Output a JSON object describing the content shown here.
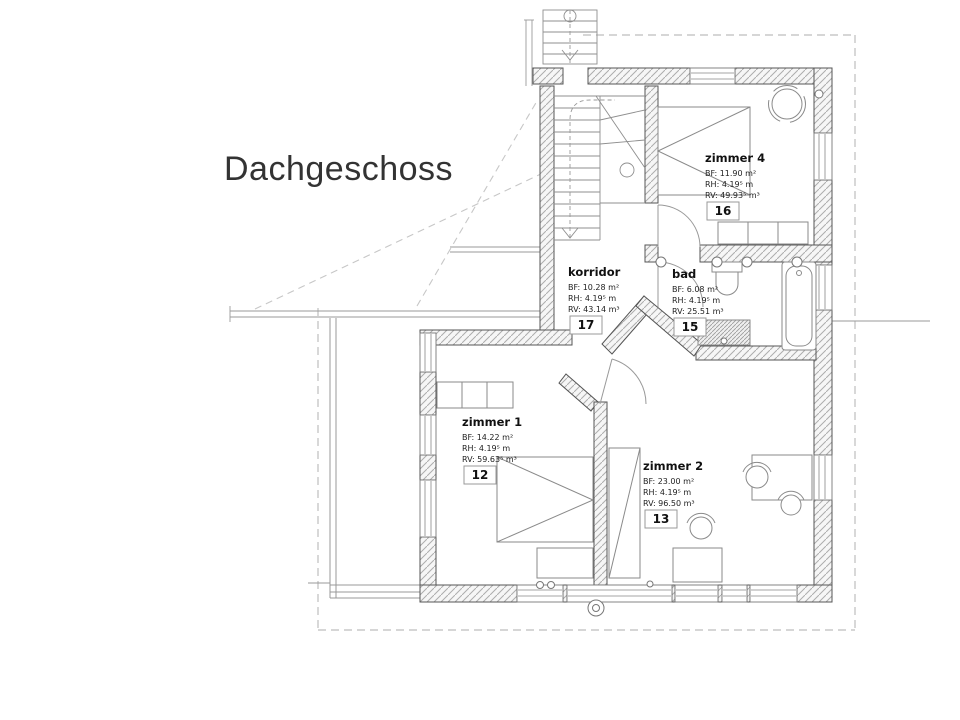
{
  "title": "Dachgeschoss",
  "plan": {
    "rooms": [
      {
        "id": "zimmer4",
        "name": "zimmer 4",
        "bf": "BF: 11.90 m²",
        "rh": "RH: 4.19⁵ m",
        "rv": "RV: 49.93⁵ m³",
        "nr": "16"
      },
      {
        "id": "korridor",
        "name": "korridor",
        "bf": "BF: 10.28 m²",
        "rh": "RH: 4.19⁵ m",
        "rv": "RV: 43.14 m³",
        "nr": "17"
      },
      {
        "id": "bad",
        "name": "bad",
        "bf": "BF: 6.08 m²",
        "rh": "RH: 4.19⁵ m",
        "rv": "RV: 25.51 m³",
        "nr": "15"
      },
      {
        "id": "zimmer1",
        "name": "zimmer 1",
        "bf": "BF: 14.22 m²",
        "rh": "RH: 4.19⁵ m",
        "rv": "RV: 59.63⁵ m³",
        "nr": "12"
      },
      {
        "id": "zimmer2",
        "name": "zimmer 2",
        "bf": "BF: 23.00 m²",
        "rh": "RH: 4.19⁵ m",
        "rv": "RV: 96.50 m³",
        "nr": "13"
      }
    ],
    "colors": {
      "wall_line": "#555555",
      "hatch_line": "#adadad",
      "thin_line": "#999999",
      "dash_line": "#bdbdbd",
      "text": "#111111",
      "background": "#ffffff"
    }
  }
}
